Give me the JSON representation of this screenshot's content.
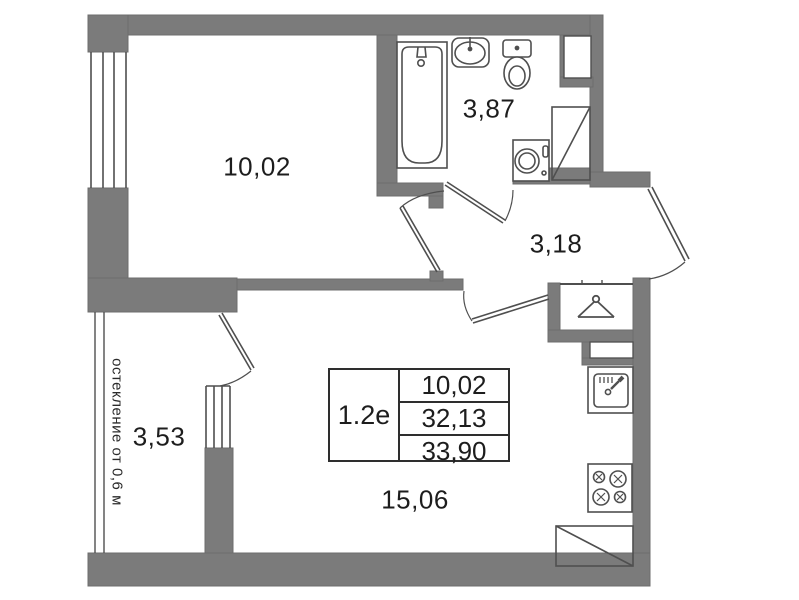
{
  "plan": {
    "title_block": {
      "unit_code": "1.2e",
      "rows": [
        "10,02",
        "32,13",
        "33,90"
      ]
    },
    "rooms": [
      {
        "id": "living-room",
        "area_label": "10,02"
      },
      {
        "id": "bathroom",
        "area_label": "3,87"
      },
      {
        "id": "hallway",
        "area_label": "3,18"
      },
      {
        "id": "balcony",
        "area_label": "3,53"
      },
      {
        "id": "kitchen-living",
        "area_label": "15,06"
      }
    ],
    "annotations": {
      "glazing_note": "остекление от 0,6 м"
    },
    "colors": {
      "wall": "#7b7b7b",
      "fixture_line": "#4f4f4f",
      "text": "#1d1d1d",
      "background": "#ffffff"
    },
    "icons": [
      "bathtub-icon",
      "bath-sink-icon",
      "toilet-icon",
      "washing-machine-icon",
      "shower-icon",
      "vent-shaft-icon",
      "hanger-icon",
      "kitchen-sink-icon",
      "stove-icon",
      "refrigerator-icon",
      "window-icon",
      "door-arc-icon"
    ]
  }
}
